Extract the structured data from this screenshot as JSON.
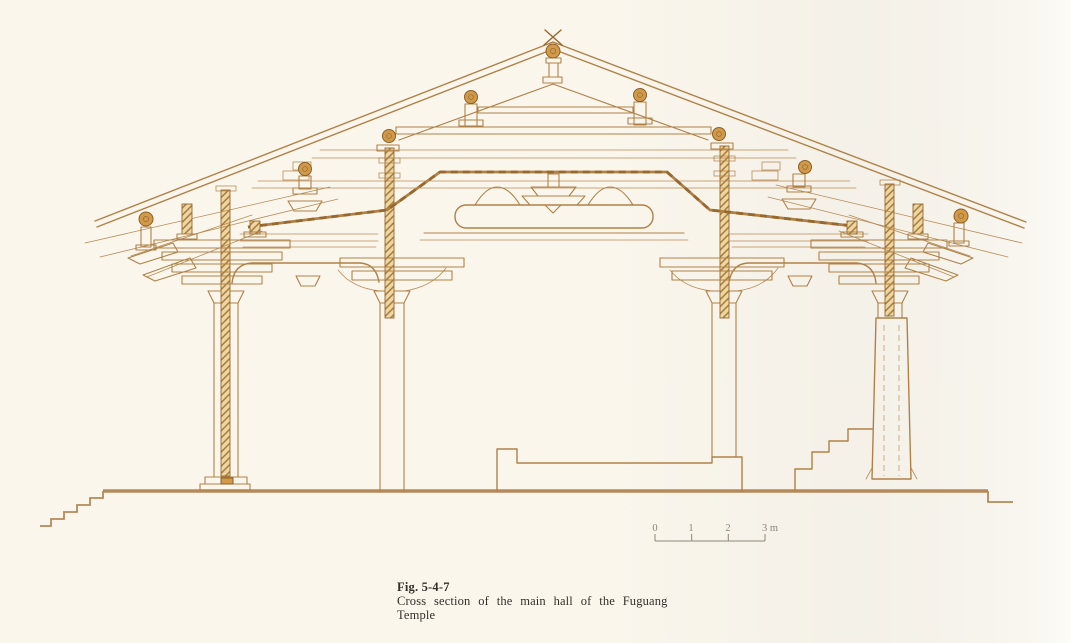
{
  "figure": {
    "label": "Fig. 5-4-7",
    "caption_line1": "Cross section of the main hall of the Fuguang",
    "caption_line2": "Temple"
  },
  "scale_bar": {
    "labels": [
      "0",
      "1",
      "2",
      "3 m"
    ]
  },
  "colors": {
    "paper": "#faf6ec",
    "shade": "#e8e5df",
    "paper_right": "#fbfaf5",
    "line": "#b08147",
    "line_dark": "#97682d",
    "wood_fill": "#d19a4a",
    "wood_edge": "#8f5f26",
    "hatch_bg": "#ecd7a4",
    "ground": "#b6895a",
    "caption_text": "#33302a",
    "scale_text": "#8d8679"
  }
}
